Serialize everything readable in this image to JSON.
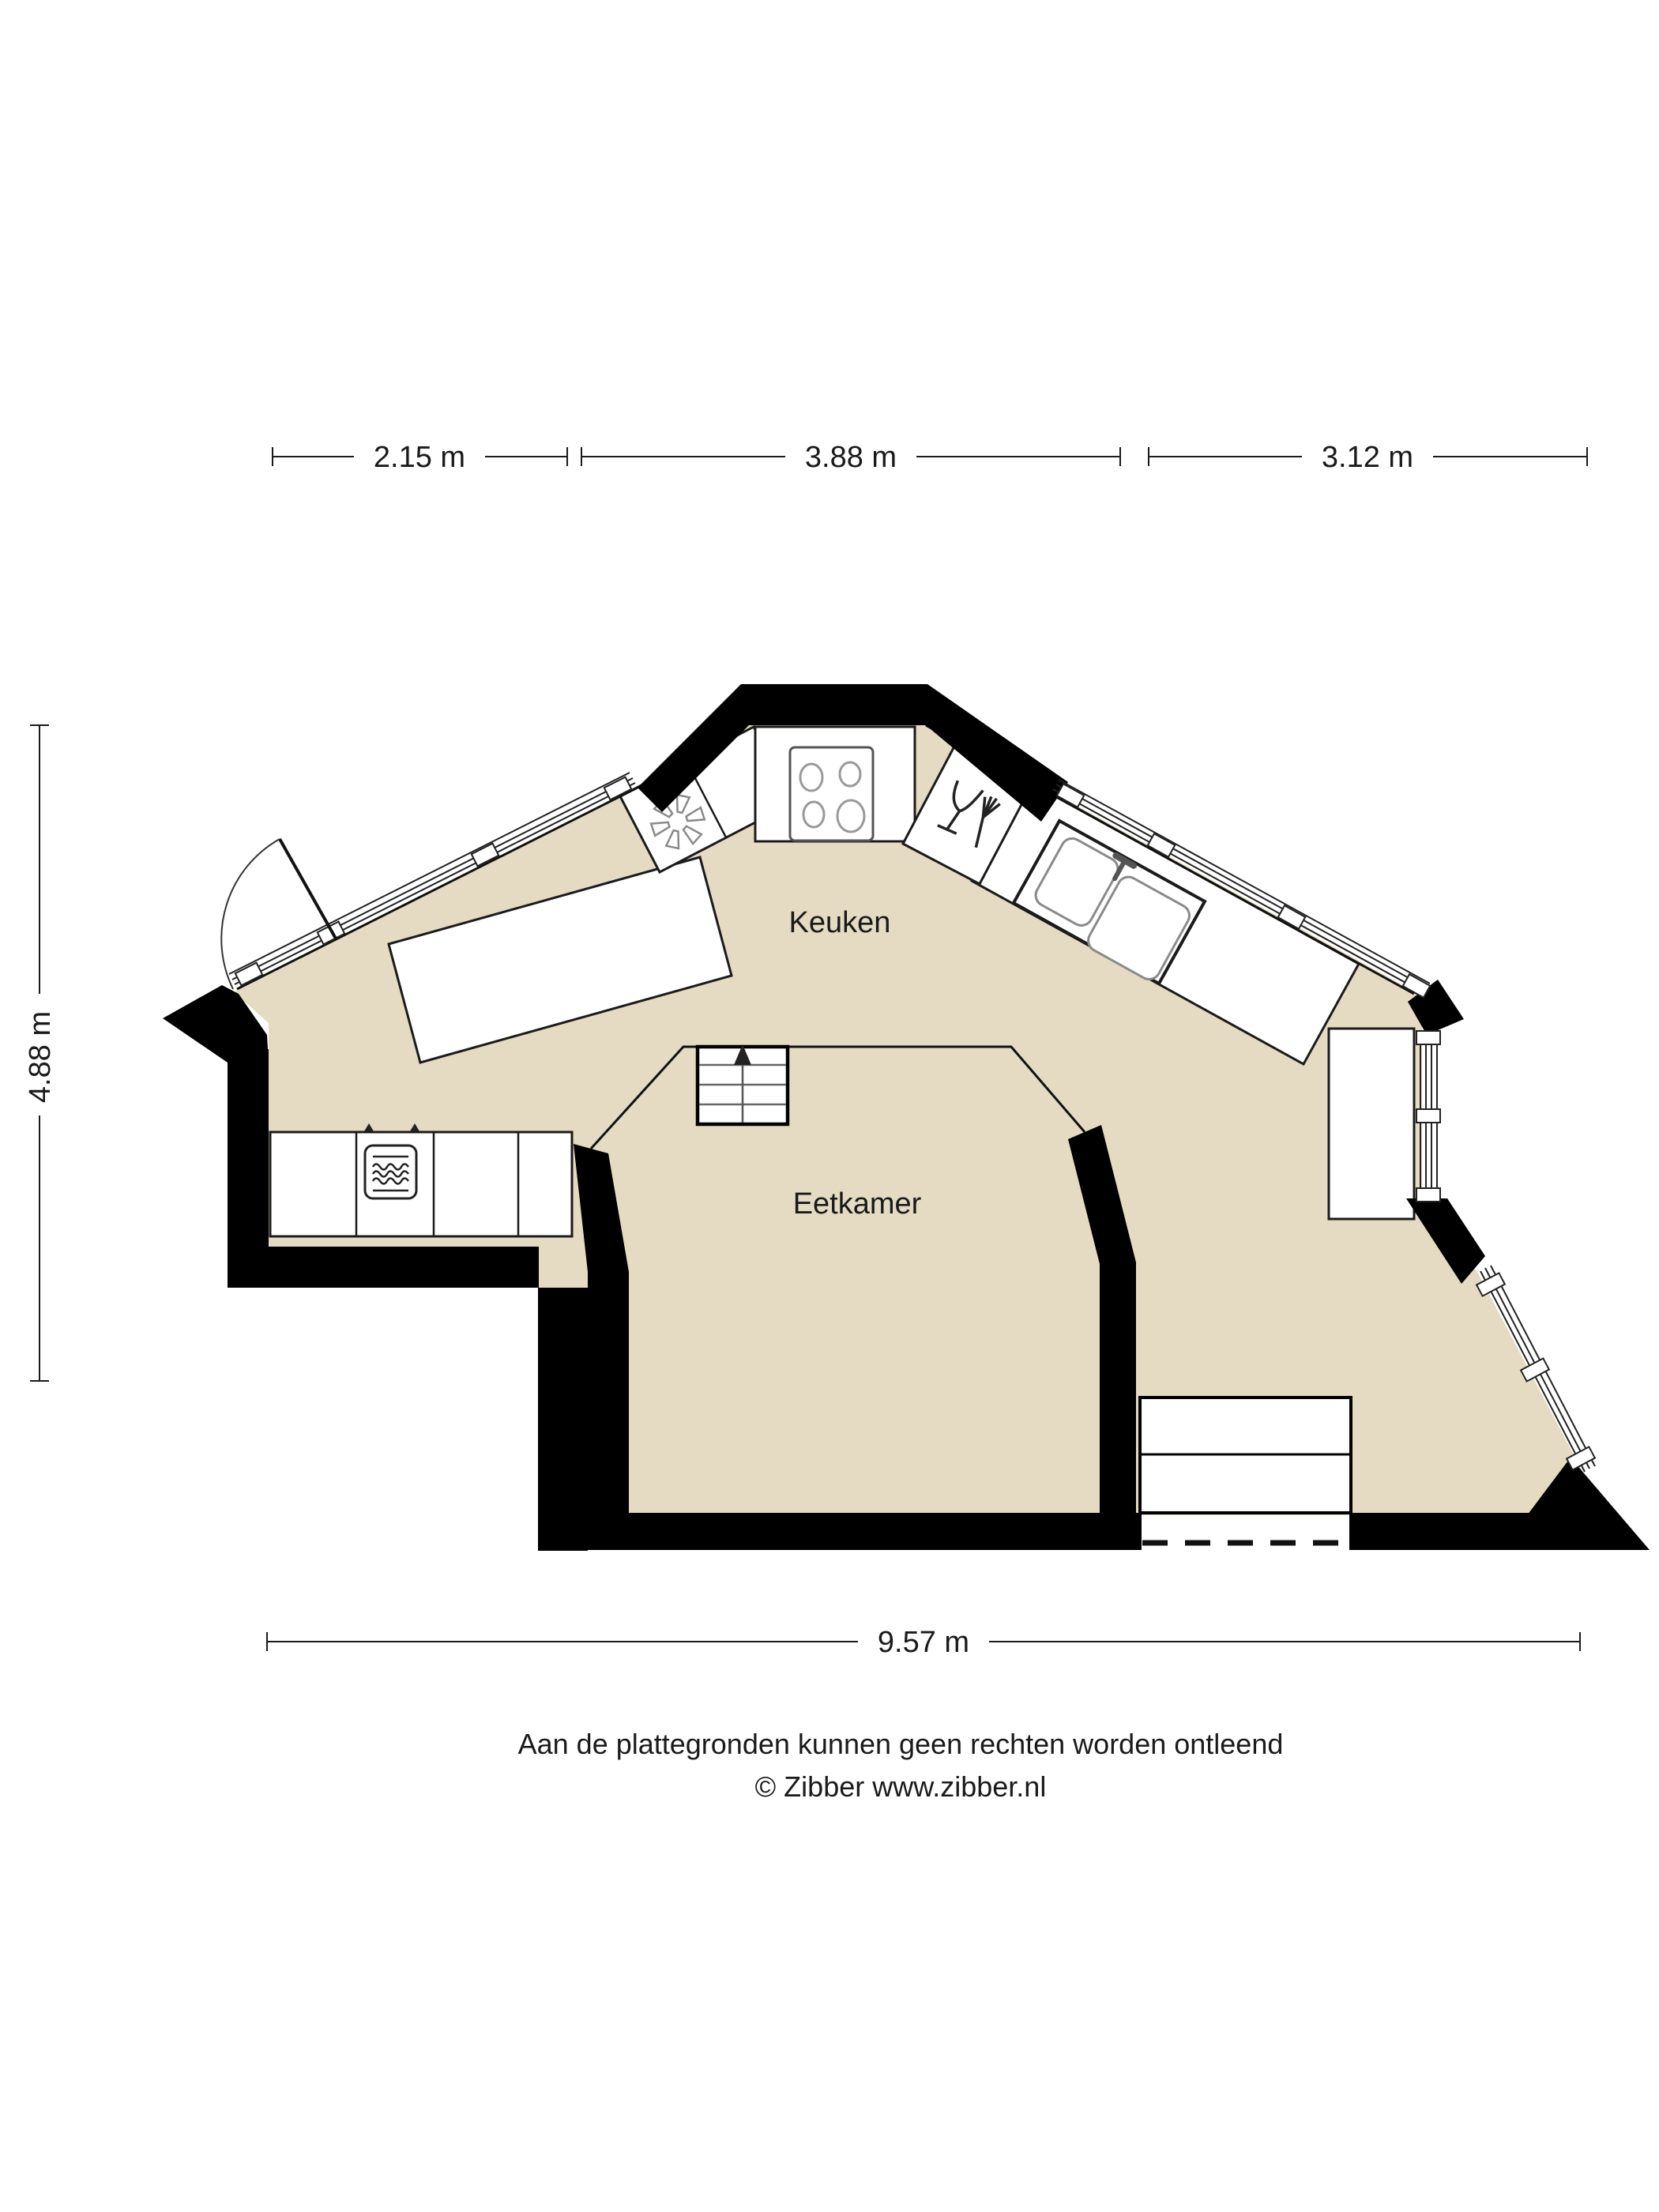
{
  "floorplan": {
    "rooms": [
      {
        "name": "keuken",
        "label": "Keuken"
      },
      {
        "name": "eetkamer",
        "label": "Eetkamer"
      }
    ],
    "dimensions": {
      "top": [
        {
          "label": "2.15 m"
        },
        {
          "label": "3.88 m"
        },
        {
          "label": "3.12 m"
        }
      ],
      "left": {
        "label": "4.88 m"
      },
      "bottom": {
        "label": "9.57 m"
      }
    },
    "colors": {
      "floor": "#E4DBC2",
      "wall": "#000000",
      "line": "#1A1A1A",
      "appliance_gray": "#8A8A8A"
    },
    "icons": [
      "freezer-icon",
      "stove-icon",
      "dishwasher-icon",
      "sink-icon",
      "microwave-icon",
      "stairs-up-arrow-icon",
      "door-swing-icon"
    ]
  },
  "footer": {
    "disclaimer": "Aan de plattegronden kunnen geen rechten worden ontleend",
    "copyright": "© Zibber www.zibber.nl"
  }
}
